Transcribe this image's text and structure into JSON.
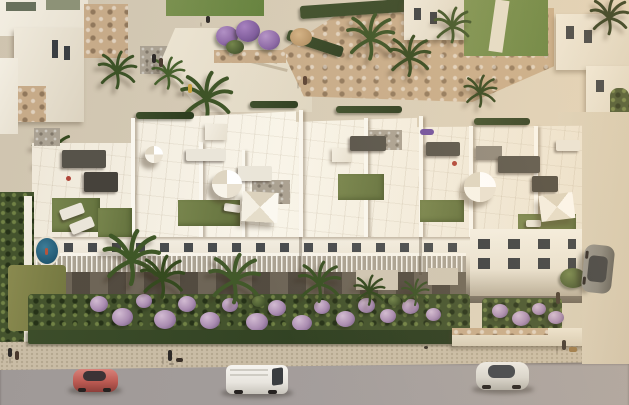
{
  "meta": {
    "subject": "Aerial architectural rendering of a white Mediterranean apartment complex with rooftop solarium terraces, landscaped gardens and a street with parked vehicles",
    "style": "computer-generated 3D visualisation, warm afternoon light, no visible text"
  },
  "palette": {
    "plaza": "#d6cbb6",
    "sidewalk": "#c9bca5",
    "road": "#9f9997",
    "win": "#3a3e42",
    "turf": "#78854d",
    "lilac": "#b99fc0",
    "stonewall": "#c7ab89",
    "building": "#f3eee2",
    "pool": "#2f6b85"
  },
  "objects": {
    "buildings": {
      "main": "three-storey white apartment block with private rooftop terraces",
      "roof_features": "artificial turf patches, white round parasols, square shade canopies, grey lounge sofas, dining sets, gravel stair bulkheads",
      "neighborhood": "white villas top-left, hillside houses and stone retaining wall top-right, small plunge pool in left villa garden"
    },
    "vehicles": [
      {
        "label": "red coupe parked on street",
        "color": "#bc5a52"
      },
      {
        "label": "white van parked on street",
        "color": "#efece6"
      },
      {
        "label": "silver car parked on street",
        "color": "#d8d5ce"
      },
      {
        "label": "grey car parked in side driveway",
        "color": "#85837c"
      }
    ],
    "landscape": [
      "palm trees",
      "round lilac flowering shrubs",
      "purple bougainvillea cluster",
      "green hedges",
      "yellow-green lawn",
      "stone retaining wall"
    ],
    "street": [
      "beige sidewalk",
      "grey asphalt road",
      "pedestrians walking",
      "person walking a dog"
    ]
  }
}
